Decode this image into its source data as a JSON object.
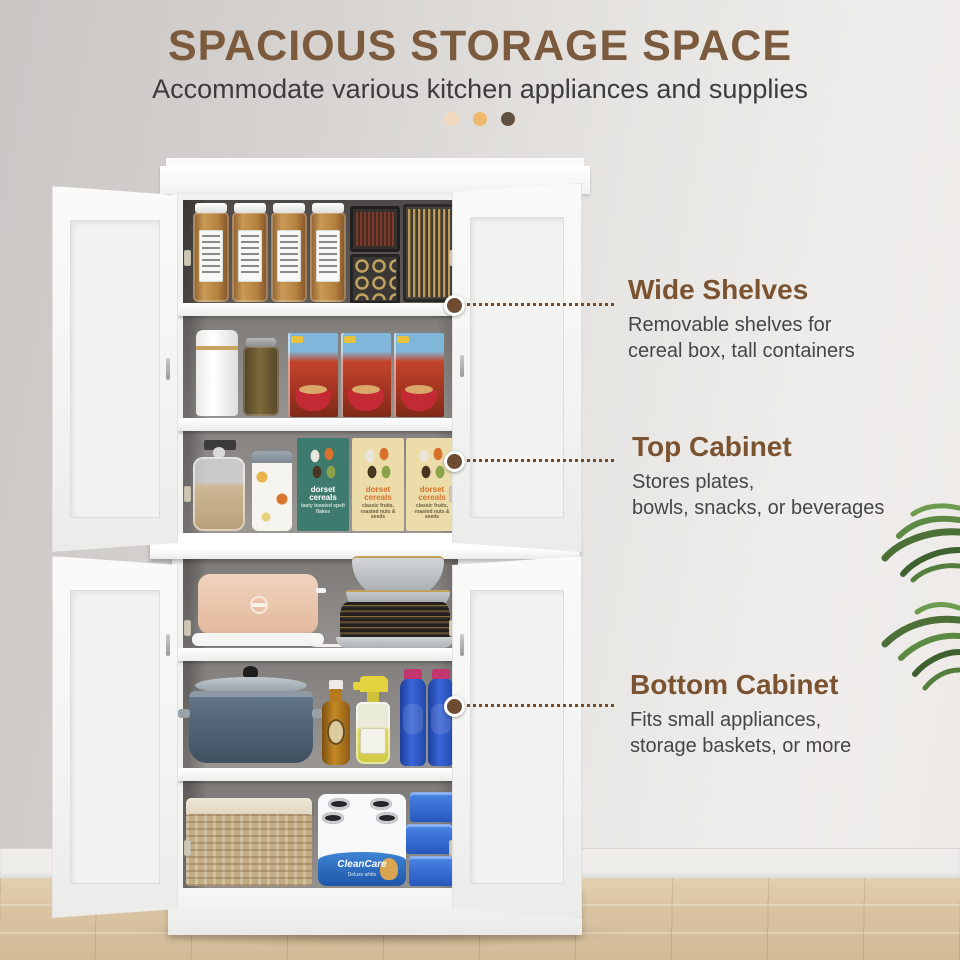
{
  "header": {
    "title": "SPACIOUS STORAGE SPACE",
    "subtitle": "Accommodate various kitchen appliances and supplies"
  },
  "pager_dots": {
    "count": 3,
    "colors": [
      "#f2d9be",
      "#eeb96a",
      "#61503f"
    ]
  },
  "callouts": {
    "wide_shelves": {
      "heading": "Wide Shelves",
      "line1": "Removable shelves for",
      "line2": "cereal box, tall containers"
    },
    "top_cabinet": {
      "heading": "Top Cabinet",
      "line1": "Stores plates,",
      "line2": "bowls, snacks, or beverages"
    },
    "bottom_cabinet": {
      "heading": "Bottom Cabinet",
      "line1": "Fits small appliances,",
      "line2": "storage baskets, or more"
    }
  },
  "products": {
    "cereal_green": {
      "brand": "dorset cereals",
      "variant": "tasty toasted spelt flakes"
    },
    "cereal_cream_1": {
      "brand": "dorset cereals",
      "variant": "classic fruits, roasted nuts & seeds"
    },
    "cereal_cream_2": {
      "brand": "dorset cereals",
      "variant": "classic fruits, roasted nuts & seeds"
    },
    "paper_towels": {
      "brand": "CleanCare",
      "variant": "Deluxe white"
    }
  },
  "colors": {
    "title_brown": "#7b5a3d",
    "callout_heading_brown": "#7c5330",
    "body_text": "#474645",
    "leader_dot_brown": "#6d4c31",
    "wall_gray": "#d6d3d0",
    "cabinet_white": "#f2f2f1",
    "floor_wood": "#d9c3a1",
    "plant_green": "#52793d"
  }
}
